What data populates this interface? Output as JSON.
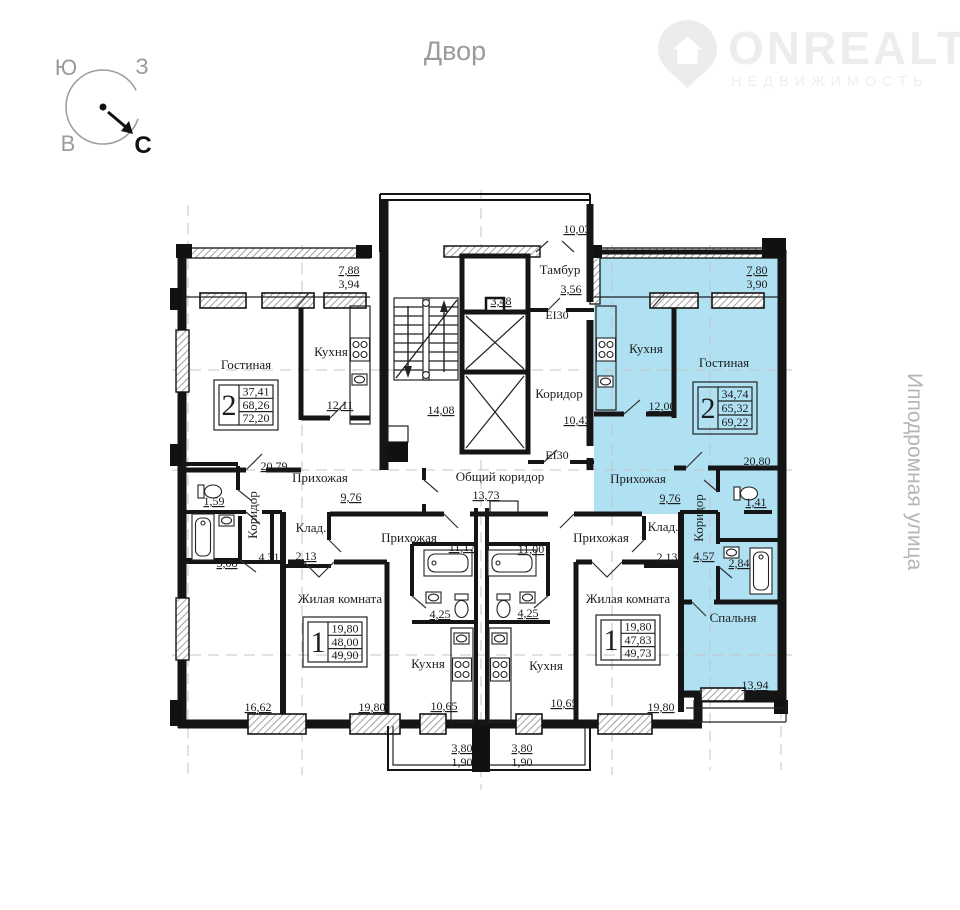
{
  "page": {
    "courtyard": "Двор",
    "street": "Ипподромная улица"
  },
  "compass": {
    "south": "Ю",
    "west": "З",
    "east": "В",
    "north": "С"
  },
  "logo": {
    "brand": "ONREALT",
    "subtitle": "НЕДВИЖИМОСТЬ"
  },
  "common_areas": {
    "tambour": {
      "label": "Тамбур",
      "dim": "3,56"
    },
    "entry_dim": "10,03",
    "lift_lobby_dim": "3,48",
    "fire_door_top": "EI30",
    "fire_door_bottom": "EI30",
    "corridor": {
      "label": "Коридор",
      "dim": "10,43"
    },
    "common_corridor": {
      "label": "Общий коридор",
      "dim": "13,73"
    },
    "stair_hall_dim": "14,08"
  },
  "apartments": {
    "left_two_room": {
      "rooms_count": "2",
      "area_living": "37,41",
      "area_usable": "68,26",
      "area_total": "72,20",
      "living": {
        "label": "Гостиная",
        "dim": "20,79"
      },
      "kitchen": {
        "label": "Кухня",
        "dim": "12,11"
      },
      "hall": {
        "label": "Прихожая",
        "dim": "9,76"
      },
      "corridor": {
        "label": "Коридор",
        "dim": "4,31"
      },
      "wc_dim": "1,59",
      "bath_dim": "3,08",
      "bedroom_dim": "16,62",
      "balcony_full": "7,88",
      "balcony_half": "3,94"
    },
    "right_two_room": {
      "rooms_count": "2",
      "area_living": "34,74",
      "area_usable": "65,32",
      "area_total": "69,22",
      "living": {
        "label": "Гостиная",
        "dim": "20,80"
      },
      "kitchen": {
        "label": "Кухня",
        "dim": "12,00"
      },
      "hall": {
        "label": "Прихожая",
        "dim": "9,76"
      },
      "corridor": {
        "label": "Коридор",
        "dim": "4,57"
      },
      "bedroom": {
        "label": "Спальня",
        "dim": "13,94"
      },
      "wc_dim": "1,41",
      "bath_dim": "2,84",
      "balcony_full": "7,80",
      "balcony_half": "3,90"
    },
    "left_one_room": {
      "rooms_count": "1",
      "area_living": "19,80",
      "area_usable": "48,00",
      "area_total": "49,90",
      "room": {
        "label": "Жилая комната",
        "dim": "19,80"
      },
      "kitchen": {
        "label": "Кухня",
        "dim": "10,65"
      },
      "hall": {
        "label": "Прихожая",
        "dim": "11,17"
      },
      "storage": {
        "label": "Клад.",
        "dim": "2,13"
      },
      "bath_dim": "4,25",
      "balcony_full": "3,80",
      "balcony_half": "1,90"
    },
    "right_one_room": {
      "rooms_count": "1",
      "area_living": "19,80",
      "area_usable": "47,83",
      "area_total": "49,73",
      "room": {
        "label": "Жилая комната",
        "dim": "19,80"
      },
      "kitchen": {
        "label": "Кухня",
        "dim": "10,65"
      },
      "hall": {
        "label": "Прихожая",
        "dim": "11,00"
      },
      "storage": {
        "label": "Клад.",
        "dim": "2,13"
      },
      "bath_dim": "4,25",
      "balcony_full": "3,80",
      "balcony_half": "1,90"
    }
  }
}
